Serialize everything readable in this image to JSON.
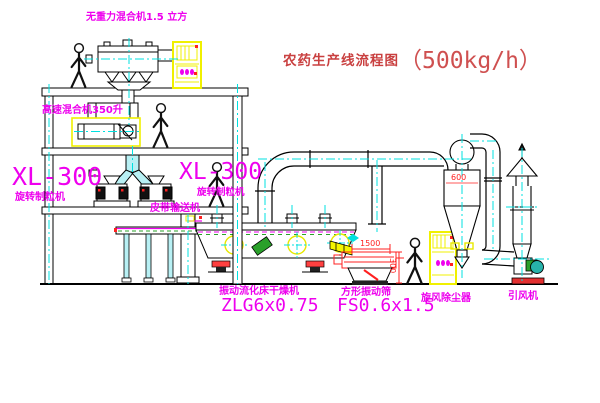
{
  "title": {
    "name": "农药生产线流程图",
    "capacity": "（500kg/h）"
  },
  "equipment": {
    "mixer_top": {
      "label": "无重力混合机1.5 立方"
    },
    "mixer_350": {
      "label": "高速混合机350升"
    },
    "granulator_left": {
      "model": "XL-300",
      "label": "旋转制粒机"
    },
    "granulator_right": {
      "model": "XL-300",
      "label": "旋转制粒机"
    },
    "belt_conveyor": {
      "label": "皮带输送机"
    },
    "dryer": {
      "label": "振动流化床干燥机",
      "model": "ZLG6x0.75"
    },
    "screen": {
      "label": "方形振动筛",
      "model": "FS0.6x1.5"
    },
    "cyclone": {
      "label": "旋风除尘器"
    },
    "fan": {
      "label": "引风机"
    }
  },
  "dimensions": {
    "screen_length": "1500",
    "screen_height": "300",
    "cyclone_diameter": "600"
  },
  "colors": {
    "label_magenta": "#ee00ee",
    "title_red": "#c94040",
    "dimension_red": "#ff2020",
    "centerline_cyan": "#00e0e0",
    "cabinet_yellow": "#f0f000",
    "duct_fill_cyan": "#b8f0f4",
    "motor_green": "#2aa02a",
    "fan_teal": "#27b3ab"
  }
}
